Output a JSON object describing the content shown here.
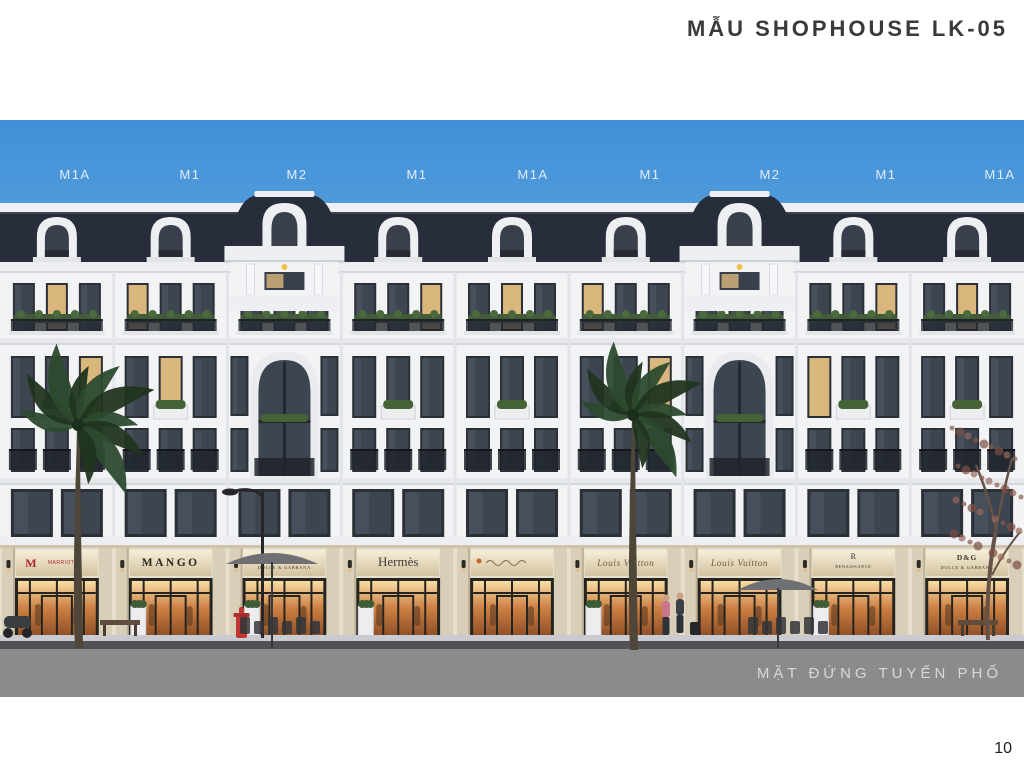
{
  "slide": {
    "title": "MẪU SHOPHOUSE LK-05",
    "caption": "MẶT ĐỨNG TUYẾN PHỐ",
    "page_number": "10"
  },
  "rendering": {
    "unit_labels": [
      {
        "text": "M1A",
        "x": 75
      },
      {
        "text": "M1",
        "x": 190
      },
      {
        "text": "M2",
        "x": 297
      },
      {
        "text": "M1",
        "x": 417
      },
      {
        "text": "M1A",
        "x": 533
      },
      {
        "text": "M1",
        "x": 650
      },
      {
        "text": "M2",
        "x": 770
      },
      {
        "text": "M1",
        "x": 886
      },
      {
        "text": "M1A",
        "x": 1000
      }
    ],
    "shops": [
      {
        "style": "logo-red",
        "name": "MARRIOTT",
        "color": "#b5282f"
      },
      {
        "style": "caps",
        "name": "MANGO"
      },
      {
        "style": "two-line",
        "name": "D&G",
        "sub": "DOLCE & GABBANA"
      },
      {
        "style": "serif",
        "name": "Hermès"
      },
      {
        "style": "script",
        "name": "",
        "logo_color": "#c4622d"
      },
      {
        "style": "script",
        "name": "Louis Vuitton"
      },
      {
        "style": "script",
        "name": "Louis Vuitton"
      },
      {
        "style": "monogram",
        "name": "RENAISSANCE",
        "monogram": "R"
      },
      {
        "style": "two-line",
        "name": "D&G",
        "sub": "DOLCE & GABBANA"
      }
    ],
    "colors": {
      "sky_top": "#3f90d8",
      "sky_bottom": "#a9cbe6",
      "roof": "#272d3a",
      "facade": "#f2f3f5",
      "cornice": "#edeff2",
      "window_glass": "#3d4550",
      "window_frame": "#2b2f36",
      "storefront_stone": "#d9ceb8",
      "road": "#8b8b8b",
      "curb": "#515156",
      "sidewalk": "#c9cbd0",
      "palm_green": "#20351f",
      "label_color": "#eef4fa"
    }
  }
}
